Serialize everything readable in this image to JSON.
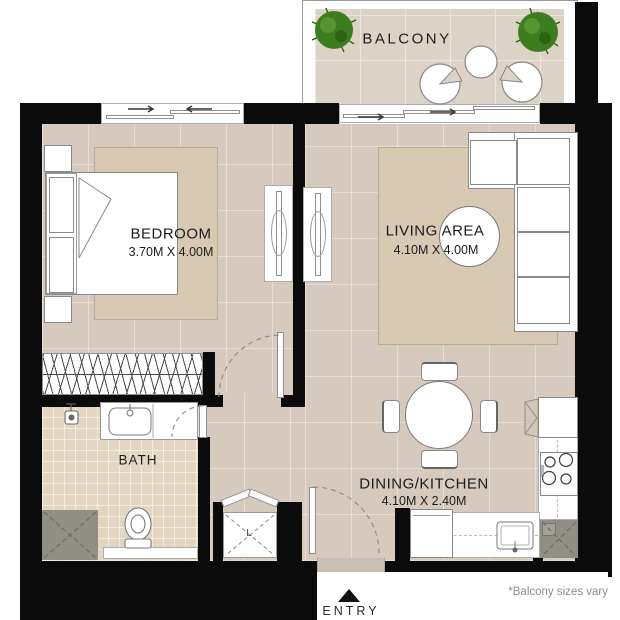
{
  "plan": {
    "balcony": {
      "label": "BALCONY"
    },
    "bedroom": {
      "label": "BEDROOM",
      "dims": "3.70M X 4.00M"
    },
    "living": {
      "label": "LIVING AREA",
      "dims": "4.10M X 4.00M"
    },
    "bath": {
      "label": "BATH"
    },
    "dining": {
      "label": "DINING/KITCHEN",
      "dims": "4.10M X 2.40M"
    },
    "closet": {
      "label": "L"
    }
  },
  "entry": {
    "label": "ENTRY"
  },
  "footnote": "*Balcony sizes vary",
  "colors": {
    "wall": "#0b0b0b",
    "floor": "#d5cabd",
    "bath_floor": "#e2d6c0",
    "balcony_floor": "#dcd2c5",
    "rug": "#d7c9b2",
    "shower_gray": "#918e86",
    "plant_green": "#3c7d20",
    "fixture_white": "#ffffff"
  }
}
